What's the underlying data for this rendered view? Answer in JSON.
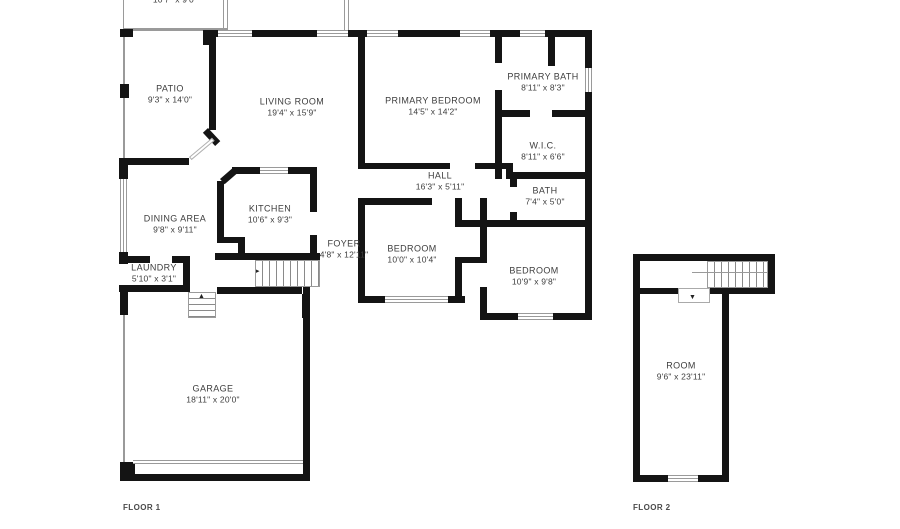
{
  "title": "Floor plan",
  "floors": {
    "floor1": {
      "tag": "FLOOR 1",
      "partial_room": {
        "dims": "10'7\" x 9'0\""
      },
      "rooms": {
        "patio": {
          "name": "PATIO",
          "dims": "9'3\" x 14'0\""
        },
        "living": {
          "name": "LIVING ROOM",
          "dims": "19'4\" x 15'9\""
        },
        "primary_bedroom": {
          "name": "PRIMARY BEDROOM",
          "dims": "14'5\" x 14'2\""
        },
        "primary_bath": {
          "name": "PRIMARY BATH",
          "dims": "8'11\" x 8'3\""
        },
        "wic": {
          "name": "W.I.C.",
          "dims": "8'11\" x 6'6\""
        },
        "hall": {
          "name": "HALL",
          "dims": "16'3\" x 5'11\""
        },
        "bath": {
          "name": "BATH",
          "dims": "7'4\" x 5'0\""
        },
        "dining": {
          "name": "DINING AREA",
          "dims": "9'8\" x 9'11\""
        },
        "kitchen": {
          "name": "KITCHEN",
          "dims": "10'6\" x 9'3\""
        },
        "foyer": {
          "name": "FOYER",
          "dims": "4'8\" x 12'11\""
        },
        "bedroom1": {
          "name": "BEDROOM",
          "dims": "10'0\" x 10'4\""
        },
        "bedroom2": {
          "name": "BEDROOM",
          "dims": "10'9\" x 9'8\""
        },
        "laundry": {
          "name": "LAUNDRY",
          "dims": "5'10\" x 3'1\""
        },
        "garage": {
          "name": "GARAGE",
          "dims": "18'11\" x 20'0\""
        }
      }
    },
    "floor2": {
      "tag": "FLOOR 2",
      "rooms": {
        "room": {
          "name": "ROOM",
          "dims": "9'6\" x 23'11\""
        }
      }
    }
  },
  "icons": {
    "stairs_up_arrow": "▲",
    "stairs_down_arrow": "▼",
    "stairs_direction_arrow": "▸"
  },
  "colors": {
    "wall": "#141414",
    "text": "#3d3d3d",
    "thin_line": "#9a9a9a",
    "background": "#ffffff"
  }
}
